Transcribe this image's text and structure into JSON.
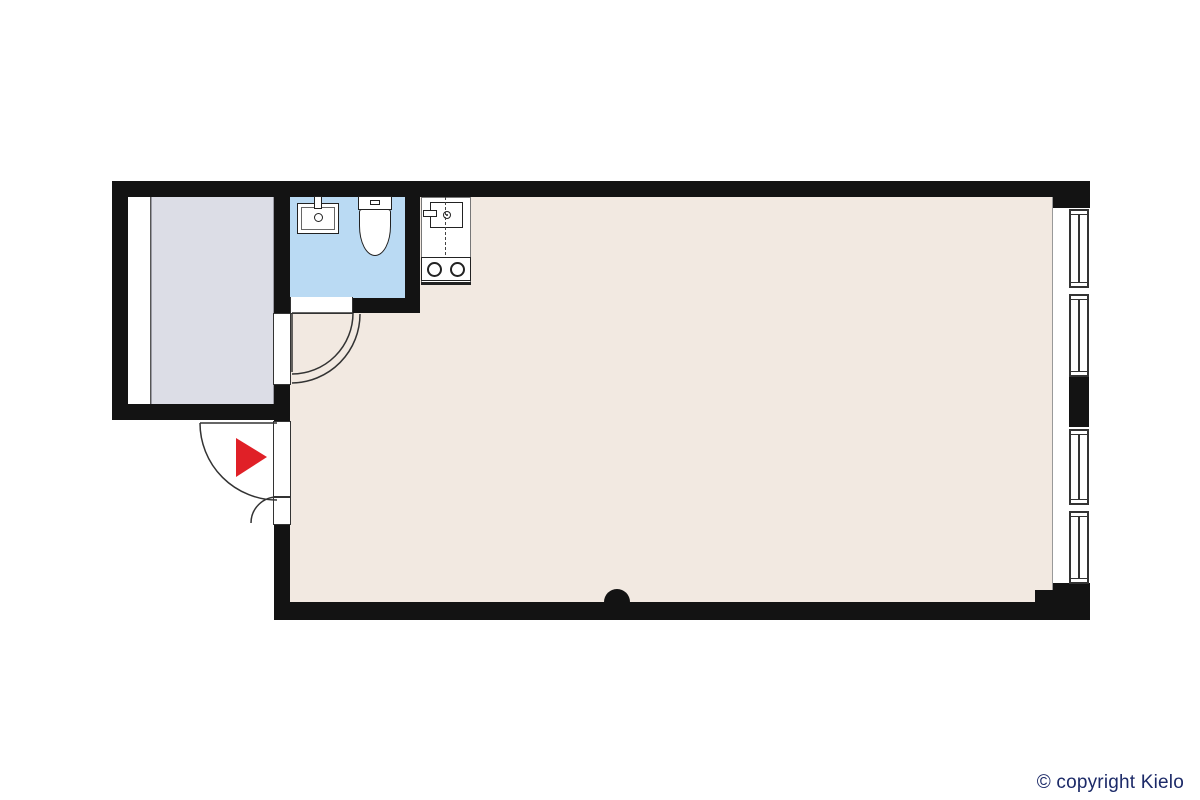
{
  "footer": {
    "copyright": "© copyright Kielo"
  },
  "colors": {
    "background": "#ffffff",
    "wall": "#131313",
    "line": "#333333",
    "floor-main": "#f2e9e1",
    "floor-bathroom": "#badaf3",
    "floor-sideroom": "#dcdde6",
    "fixture-outline": "#222222",
    "arrow": "#e02027",
    "copyright": "#1c2a68"
  },
  "plan": {
    "rooms": [
      {
        "name": "main-room",
        "floor_color": "#f2e9e1"
      },
      {
        "name": "bathroom",
        "floor_color": "#badaf3"
      },
      {
        "name": "side-room",
        "floor_color": "#dcdde6"
      }
    ],
    "fixtures": [
      {
        "name": "bathroom-sink"
      },
      {
        "name": "toilet"
      },
      {
        "name": "kitchenette-sink"
      },
      {
        "name": "kitchenette-stove",
        "burners": 2
      }
    ],
    "windows": {
      "count": 4,
      "wall": "right"
    },
    "doors": [
      {
        "name": "entrance-double-door",
        "swing": "outward"
      },
      {
        "name": "bathroom-door",
        "swing": "inward"
      },
      {
        "name": "side-room-door",
        "swing": "inward"
      }
    ],
    "markers": [
      {
        "name": "entrance-arrow",
        "color": "#e02027"
      },
      {
        "name": "wall-dot",
        "color": "#131313"
      }
    ]
  }
}
